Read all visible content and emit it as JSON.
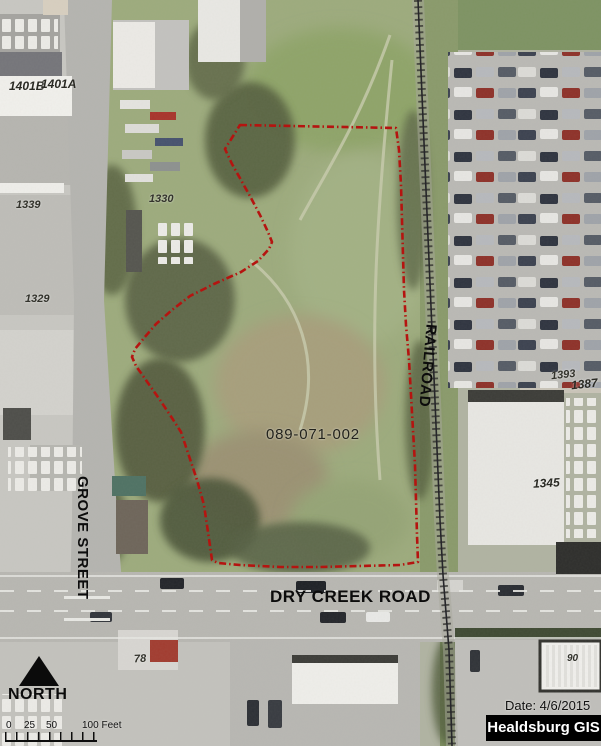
{
  "map_labels": {
    "parcel_id": "089-071-002",
    "grove_street": "GROVE STREET",
    "dry_creek_road": "DRY CREEK ROAD",
    "railroad": "RAILROAD",
    "addresses": {
      "a1401b": "1401B",
      "a1401a": "1401A",
      "a1339": "1339",
      "a1330": "1330",
      "a1329": "1329",
      "a1393": "1393",
      "a1387": "1387",
      "a1345": "1345",
      "a78": "78",
      "a90": "90"
    }
  },
  "legend": {
    "north": "NORTH",
    "scale": {
      "t0": "0",
      "t25": "25",
      "t50": "50",
      "t100": "100 Feet"
    },
    "date": "Date: 4/6/2015",
    "attribution": "Healdsburg GIS"
  },
  "colors": {
    "parcel_boundary": "#b51410",
    "attribution_bg": "#000000",
    "attribution_text": "#ffffff"
  }
}
